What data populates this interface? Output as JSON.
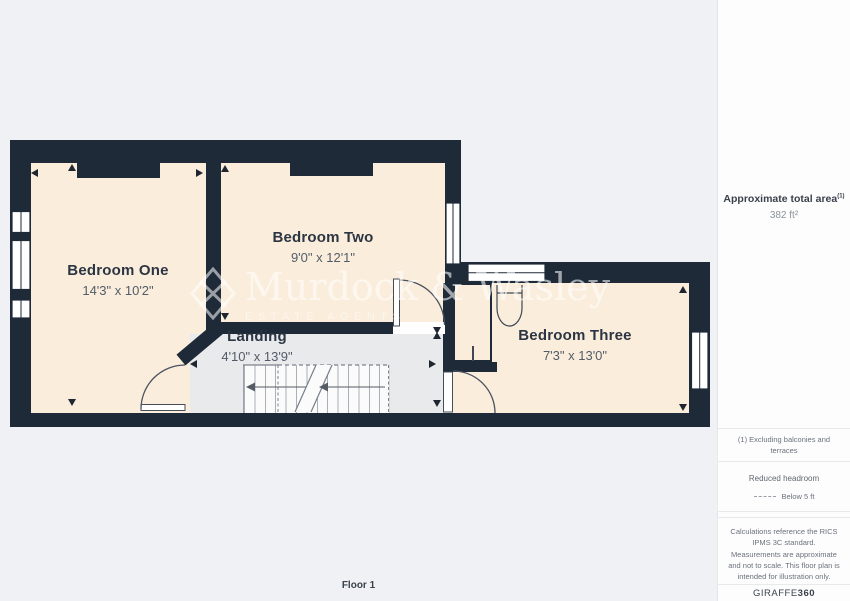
{
  "floorplan": {
    "floor_label": "Floor 1",
    "rooms": [
      {
        "name": "Bedroom One",
        "dimensions": "14'3\" x 10'2\""
      },
      {
        "name": "Bedroom Two",
        "dimensions": "9'0\" x 12'1\""
      },
      {
        "name": "Bedroom Three",
        "dimensions": "7'3\" x 13'0\""
      },
      {
        "name": "Landing",
        "dimensions": "4'10\" x 13'9\""
      }
    ],
    "colors": {
      "wall": "#1e2a38",
      "room_fill": "#faeddb",
      "landing_fill": "#e9eaec",
      "canvas": "#eff1f4"
    }
  },
  "watermark": {
    "brand": "Murdock & Wasley",
    "tagline": "ESTATE AGENTS"
  },
  "sidebar": {
    "area_title": "Approximate total area",
    "area_note_ref": "(1)",
    "area_value": "382 ft²",
    "note_exclusions": "(1) Excluding balconies and terraces",
    "headroom_title": "Reduced headroom",
    "headroom_legend": "Below 5 ft",
    "disclaimer": "Calculations reference the RICS IPMS 3C standard. Measurements are approximate and not to scale. This floor plan is intended for illustration only.",
    "brand_name": "GIRAFFE",
    "brand_suffix": "360"
  }
}
